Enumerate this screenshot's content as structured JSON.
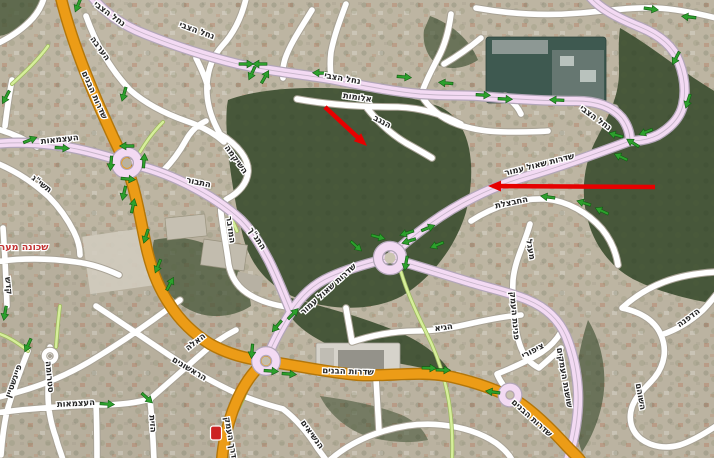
{
  "map": {
    "region_label": {
      "text": "שכונה מער",
      "color": "#c23232"
    },
    "road_labels": [
      {
        "t": "נחל הצבי",
        "x": 108,
        "y": 16,
        "r": 36,
        "s": 9
      },
      {
        "t": "נחל הצבי",
        "x": 196,
        "y": 33,
        "r": 20,
        "s": 9
      },
      {
        "t": "נחל הצבי",
        "x": 342,
        "y": 81,
        "r": 10,
        "s": 9
      },
      {
        "t": "נחל הצבי",
        "x": 594,
        "y": 120,
        "r": 36,
        "s": 9
      },
      {
        "t": "הערבה",
        "x": 98,
        "y": 50,
        "r": 54
      },
      {
        "t": "אלומות",
        "x": 357,
        "y": 100,
        "r": 8
      },
      {
        "t": "הנגב",
        "x": 381,
        "y": 124,
        "r": 28
      },
      {
        "t": "העצמאות",
        "x": 60,
        "y": 142,
        "r": -6
      },
      {
        "t": "תשי\"ג",
        "x": 40,
        "y": 186,
        "r": 38
      },
      {
        "t": "השיקמה",
        "x": 234,
        "y": 161,
        "r": 54
      },
      {
        "t": "התבור",
        "x": 198,
        "y": 185,
        "r": 12
      },
      {
        "t": "המדבר",
        "x": 228,
        "y": 230,
        "r": 82
      },
      {
        "t": "התנ\"ך",
        "x": 255,
        "y": 240,
        "r": 56
      },
      {
        "t": "שדרות הבנים",
        "x": 92,
        "y": 96,
        "r": 66,
        "s": 10
      },
      {
        "t": "שדרות שאול עמור",
        "x": 540,
        "y": 167,
        "r": -14,
        "s": 9.5
      },
      {
        "t": "שדרות שאול עמור",
        "x": 330,
        "y": 291,
        "r": -42,
        "s": 9
      },
      {
        "t": "החבצלת",
        "x": 512,
        "y": 205,
        "r": -12
      },
      {
        "t": "מעגל",
        "x": 528,
        "y": 250,
        "r": 80
      },
      {
        "t": "פנינת העמק",
        "x": 512,
        "y": 316,
        "r": 85
      },
      {
        "t": "ציפורי",
        "x": 534,
        "y": 353,
        "r": -28
      },
      {
        "t": "שושנת העמקים",
        "x": 562,
        "y": 378,
        "r": 80
      },
      {
        "t": "השוהם",
        "x": 638,
        "y": 397,
        "r": 80
      },
      {
        "t": "הדפנה",
        "x": 690,
        "y": 320,
        "r": -36
      },
      {
        "t": "הגיא",
        "x": 444,
        "y": 330,
        "r": -8
      },
      {
        "t": "שדרות הבנים",
        "x": 348,
        "y": 374,
        "r": 2,
        "s": 10
      },
      {
        "t": "שדרות הבנים",
        "x": 530,
        "y": 420,
        "r": 42,
        "s": 10
      },
      {
        "t": "דרך העמק",
        "x": 228,
        "y": 438,
        "r": 80,
        "s": 9.5
      },
      {
        "t": "הראשונים",
        "x": 188,
        "y": 371,
        "r": 31
      },
      {
        "t": "סטרומה",
        "x": 47,
        "y": 377,
        "r": 85
      },
      {
        "t": "קדש",
        "x": 6,
        "y": 286,
        "r": 84
      },
      {
        "t": "פיינשטיין",
        "x": 16,
        "y": 382,
        "r": -70
      },
      {
        "t": "העצמאות",
        "x": 76,
        "y": 406,
        "r": -3
      },
      {
        "t": "האלה",
        "x": 197,
        "y": 344,
        "r": -38
      },
      {
        "t": "הנשיאים",
        "x": 310,
        "y": 436,
        "r": 54
      },
      {
        "t": "הזית",
        "x": 150,
        "y": 424,
        "r": 86
      }
    ],
    "green_arrows": [
      {
        "x": 246,
        "y": 64,
        "r": 0
      },
      {
        "x": 260,
        "y": 64,
        "r": 180
      },
      {
        "x": 252,
        "y": 73,
        "r": 115
      },
      {
        "x": 265,
        "y": 77,
        "r": -60
      },
      {
        "x": 320,
        "y": 73,
        "r": 182
      },
      {
        "x": 404,
        "y": 77,
        "r": 5
      },
      {
        "x": 446,
        "y": 83,
        "r": 185
      },
      {
        "x": 483,
        "y": 95,
        "r": 3
      },
      {
        "x": 505,
        "y": 99,
        "r": 3
      },
      {
        "x": 557,
        "y": 100,
        "r": 183
      },
      {
        "x": 651,
        "y": 9,
        "r": 8
      },
      {
        "x": 689,
        "y": 17,
        "r": 186
      },
      {
        "x": 676,
        "y": 58,
        "r": 118
      },
      {
        "x": 688,
        "y": 101,
        "r": 108
      },
      {
        "x": 616,
        "y": 135,
        "r": 195
      },
      {
        "x": 633,
        "y": 143,
        "r": 212
      },
      {
        "x": 646,
        "y": 132,
        "r": 158
      },
      {
        "x": 621,
        "y": 157,
        "r": 205
      },
      {
        "x": 548,
        "y": 197,
        "r": 188
      },
      {
        "x": 584,
        "y": 203,
        "r": 197
      },
      {
        "x": 602,
        "y": 211,
        "r": 205
      },
      {
        "x": 407,
        "y": 233,
        "r": 162
      },
      {
        "x": 409,
        "y": 241,
        "r": 162
      },
      {
        "x": 428,
        "y": 228,
        "r": -22
      },
      {
        "x": 437,
        "y": 245,
        "r": 158
      },
      {
        "x": 356,
        "y": 246,
        "r": 42
      },
      {
        "x": 378,
        "y": 237,
        "r": 15
      },
      {
        "x": 406,
        "y": 263,
        "r": 100
      },
      {
        "x": 277,
        "y": 326,
        "r": 130
      },
      {
        "x": 293,
        "y": 314,
        "r": -46
      },
      {
        "x": 252,
        "y": 351,
        "r": 95
      },
      {
        "x": 271,
        "y": 371,
        "r": 4
      },
      {
        "x": 289,
        "y": 374,
        "r": 4
      },
      {
        "x": 429,
        "y": 368,
        "r": 2
      },
      {
        "x": 443,
        "y": 370,
        "r": 2
      },
      {
        "x": 78,
        "y": 5,
        "r": 112
      },
      {
        "x": 124,
        "y": 94,
        "r": 106
      },
      {
        "x": 127,
        "y": 146,
        "r": 180
      },
      {
        "x": 111,
        "y": 163,
        "r": 95
      },
      {
        "x": 128,
        "y": 179,
        "r": 5
      },
      {
        "x": 144,
        "y": 161,
        "r": -85
      },
      {
        "x": 124,
        "y": 193,
        "r": 103
      },
      {
        "x": 133,
        "y": 206,
        "r": -78
      },
      {
        "x": 146,
        "y": 236,
        "r": 108
      },
      {
        "x": 158,
        "y": 266,
        "r": 112
      },
      {
        "x": 170,
        "y": 284,
        "r": -62
      },
      {
        "x": 62,
        "y": 148,
        "r": 4
      },
      {
        "x": 30,
        "y": 140,
        "r": -22
      },
      {
        "x": 6,
        "y": 97,
        "r": 118
      },
      {
        "x": 5,
        "y": 313,
        "r": 100
      },
      {
        "x": 28,
        "y": 345,
        "r": 115
      },
      {
        "x": 107,
        "y": 404,
        "r": 4
      },
      {
        "x": 147,
        "y": 398,
        "r": 42
      },
      {
        "x": 493,
        "y": 392,
        "r": 188
      }
    ],
    "red_arrows": [
      {
        "x1": 325,
        "y1": 107,
        "x2": 367,
        "y2": 146
      },
      {
        "x1": 655,
        "y1": 187,
        "x2": 488,
        "y2": 186
      }
    ],
    "colors": {
      "arterial_road": "#ec9c17",
      "collector_road": "#f3daf3",
      "local_road": "#ffffff",
      "path_road": "#d6ef9a",
      "traffic_arrow": "#2da02d",
      "annotation_arrow": "#e60000",
      "region_label": "#c23232"
    }
  }
}
